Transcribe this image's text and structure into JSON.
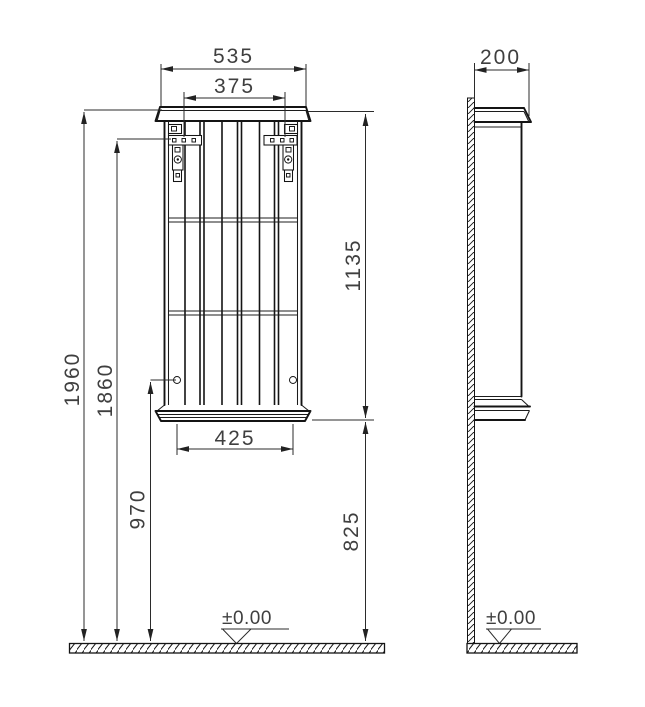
{
  "drawing": {
    "type": "wall-hung cabinet dimension drawing",
    "front_view": {
      "width_overall": "535",
      "hanger_spacing": "375",
      "cabinet_height": "1135",
      "overall_height": "1960",
      "hanger_height": "1860",
      "fixing_height": "970",
      "fixing_spacing": "425",
      "clearance_below": "825",
      "floor_level": "±0.00"
    },
    "side_view": {
      "depth": "200",
      "floor_level": "±0.00"
    },
    "colors": {
      "line": "#141414",
      "dimension_text": "#3f3f3f",
      "background": "#ffffff"
    }
  }
}
